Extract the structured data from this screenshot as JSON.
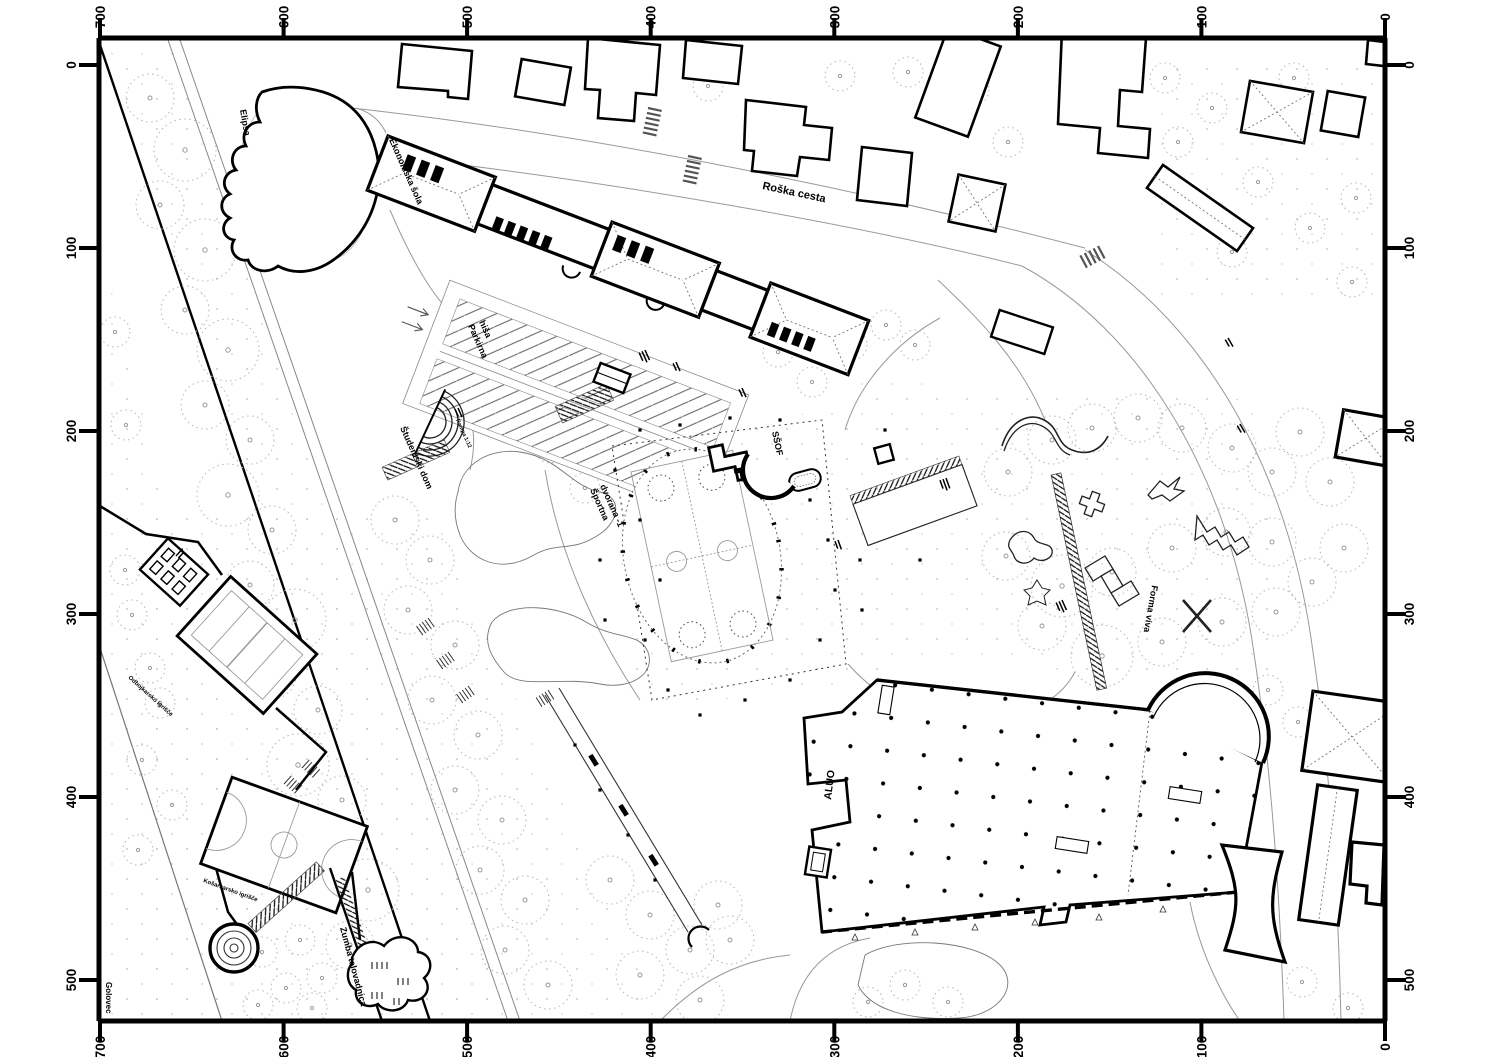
{
  "plan": {
    "rulers": {
      "top": [
        "700",
        "600",
        "500",
        "400",
        "300",
        "200",
        "100",
        "0"
      ],
      "bottom": [
        "700",
        "600",
        "500",
        "400",
        "300",
        "200",
        "100",
        "0"
      ],
      "left": [
        "0",
        "100",
        "200",
        "300",
        "400",
        "500"
      ],
      "right": [
        "0",
        "100",
        "200",
        "300",
        "400",
        "500"
      ]
    },
    "labels": {
      "street": "Roška cesta",
      "economics_school": "Ekonomska šola",
      "parking_l1": "Parkirna",
      "parking_l2": "hiša",
      "student_dorm": "Študentski dom",
      "ramp": "Rampa 1:12",
      "hall_l1": "Športna",
      "hall_l2": "dvorana -1",
      "ssof": "SŠOF",
      "forma_viva": "Forma viva",
      "aluo": "ALUO",
      "zumba": "Zumba telovadnica",
      "golovec": "Golovec",
      "ellipse": "Elipsa",
      "court_basketball": "Košarkarsko igrišče",
      "court_volleyball": "Odbojkarsko igrišče"
    },
    "colors": {
      "ink": "#000000",
      "light": "#999999",
      "paper": "#ffffff"
    }
  }
}
